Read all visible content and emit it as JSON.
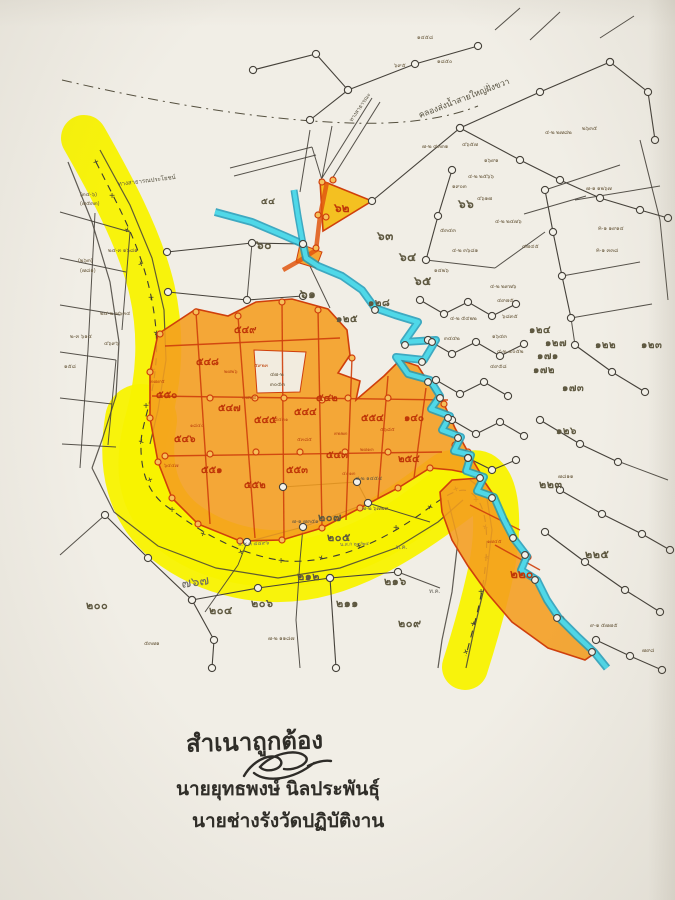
{
  "certification": {
    "line1": "สำเนาถูกต้อง",
    "line2": "นายยุทธพงษ์ นิลประพันธุ์",
    "line3": "นายช่างรังวัดปฏิบัติงาน"
  },
  "map": {
    "colors": {
      "road_highlight": "#f8f200",
      "parcel_highlight": "#f49d1f",
      "parcel_line": "#cf3f0c",
      "stream_fill": "#4fd8e8",
      "stream_edge": "#1f9cba",
      "ink": "#45413a",
      "paper": "#f1eee6"
    },
    "labels": [
      {
        "t": "๖๐",
        "x": 256,
        "y": 249,
        "c": "num",
        "s": 12
      },
      {
        "t": "๖๑",
        "x": 300,
        "y": 298,
        "c": "num",
        "s": 12
      },
      {
        "t": "๖๒",
        "x": 334,
        "y": 212,
        "c": "red",
        "s": 12
      },
      {
        "t": "๖๓",
        "x": 377,
        "y": 240,
        "c": "num",
        "s": 12
      },
      {
        "t": "๖๔",
        "x": 399,
        "y": 261,
        "c": "num",
        "s": 12
      },
      {
        "t": "๖๕",
        "x": 414,
        "y": 285,
        "c": "num",
        "s": 12
      },
      {
        "t": "๖๖",
        "x": 458,
        "y": 208,
        "c": "num",
        "s": 12
      },
      {
        "t": "๕๔",
        "x": 261,
        "y": 204,
        "c": "num",
        "s": 9
      },
      {
        "t": "๑๒๘",
        "x": 368,
        "y": 306,
        "c": "num",
        "s": 10
      },
      {
        "t": "๑๒๕",
        "x": 336,
        "y": 322,
        "c": "num",
        "s": 10
      },
      {
        "t": "๑๒๔",
        "x": 529,
        "y": 333,
        "c": "num",
        "s": 10
      },
      {
        "t": "๑๒๗",
        "x": 545,
        "y": 346,
        "c": "num",
        "s": 10
      },
      {
        "t": "๑๗๑",
        "x": 537,
        "y": 359,
        "c": "num",
        "s": 10
      },
      {
        "t": "๑๗๒",
        "x": 533,
        "y": 373,
        "c": "num",
        "s": 10
      },
      {
        "t": "๑๗๓",
        "x": 562,
        "y": 391,
        "c": "num",
        "s": 10
      },
      {
        "t": "๑๒๒",
        "x": 595,
        "y": 348,
        "c": "num",
        "s": 10
      },
      {
        "t": "๑๒๓",
        "x": 641,
        "y": 348,
        "c": "num",
        "s": 10
      },
      {
        "t": "๑๒๖",
        "x": 556,
        "y": 434,
        "c": "num",
        "s": 10
      },
      {
        "t": "๒๒๓",
        "x": 539,
        "y": 488,
        "c": "num",
        "s": 11
      },
      {
        "t": "๒๒๕",
        "x": 585,
        "y": 558,
        "c": "num",
        "s": 11
      },
      {
        "t": "๒๐๐",
        "x": 86,
        "y": 609,
        "c": "num",
        "s": 11
      },
      {
        "t": "๒๐๔",
        "x": 209,
        "y": 614,
        "c": "num",
        "s": 11
      },
      {
        "t": "๒๐๕",
        "x": 327,
        "y": 541,
        "c": "num",
        "s": 11
      },
      {
        "t": "๒๐๗",
        "x": 318,
        "y": 521,
        "c": "num",
        "s": 11
      },
      {
        "t": "๒๐๖",
        "x": 251,
        "y": 607,
        "c": "num",
        "s": 11
      },
      {
        "t": "๒๑๑",
        "x": 336,
        "y": 607,
        "c": "num",
        "s": 11
      },
      {
        "t": "๒๑๒",
        "x": 297,
        "y": 580,
        "c": "num",
        "s": 11
      },
      {
        "t": "๒๑๖",
        "x": 384,
        "y": 585,
        "c": "num",
        "s": 11
      },
      {
        "t": "๒๐๙",
        "x": 398,
        "y": 627,
        "c": "num",
        "s": 11
      },
      {
        "t": "๑๔๐",
        "x": 404,
        "y": 421,
        "c": "red",
        "s": 10
      },
      {
        "t": "๒๕๔",
        "x": 398,
        "y": 462,
        "c": "red",
        "s": 10
      },
      {
        "t": "๒๒๐",
        "x": 510,
        "y": 578,
        "c": "red",
        "s": 12
      },
      {
        "t": "๕๔๙",
        "x": 234,
        "y": 333,
        "c": "red",
        "s": 10
      },
      {
        "t": "๕๔๘",
        "x": 196,
        "y": 365,
        "c": "red",
        "s": 10
      },
      {
        "t": "๕๕๐",
        "x": 156,
        "y": 398,
        "c": "red",
        "s": 10
      },
      {
        "t": "๕๔๗",
        "x": 218,
        "y": 411,
        "c": "red",
        "s": 10
      },
      {
        "t": "๕๔๖",
        "x": 174,
        "y": 442,
        "c": "red",
        "s": 10
      },
      {
        "t": "๕๕๑",
        "x": 201,
        "y": 473,
        "c": "red",
        "s": 10
      },
      {
        "t": "๕๕๒",
        "x": 244,
        "y": 488,
        "c": "red",
        "s": 10
      },
      {
        "t": "๕๔๕",
        "x": 254,
        "y": 423,
        "c": "red",
        "s": 10
      },
      {
        "t": "๕๔๔",
        "x": 294,
        "y": 415,
        "c": "red",
        "s": 10
      },
      {
        "t": "๕๕๓",
        "x": 286,
        "y": 473,
        "c": "red",
        "s": 10
      },
      {
        "t": "๕๔๓",
        "x": 326,
        "y": 458,
        "c": "red",
        "s": 10
      },
      {
        "t": "๕๔๒",
        "x": 316,
        "y": 401,
        "c": "red",
        "s": 10
      },
      {
        "t": "๕๕๔",
        "x": 361,
        "y": 421,
        "c": "red",
        "s": 10
      },
      {
        "t": "๔-๒ ๒๗๘๒",
        "x": 545,
        "y": 134,
        "c": "tiny",
        "s": 5.5
      },
      {
        "t": "๒๖๓๕",
        "x": 582,
        "y": 130,
        "c": "tiny",
        "s": 5.5
      },
      {
        "t": "๗-๑ ๑๒๖๗",
        "x": 586,
        "y": 190,
        "c": "tiny",
        "s": 5.5
      },
      {
        "t": "ค-๑ ๑๙๑๔",
        "x": 598,
        "y": 230,
        "c": "tiny",
        "s": 5.5
      },
      {
        "t": "ค-๑ ๓๓๘",
        "x": 596,
        "y": 252,
        "c": "tiny",
        "s": 5.5
      },
      {
        "t": "๔-๒ ๒๔๗๖",
        "x": 495,
        "y": 223,
        "c": "tiny",
        "s": 5.5
      },
      {
        "t": "๔๗๔๕",
        "x": 522,
        "y": 248,
        "c": "tiny",
        "s": 5.5
      },
      {
        "t": "๔-๒ ๒๙๗๖",
        "x": 490,
        "y": 288,
        "c": "tiny",
        "s": 5.5
      },
      {
        "t": "๔๙๗๕",
        "x": 497,
        "y": 302,
        "c": "tiny",
        "s": 5.5
      },
      {
        "t": "๖๘๓๕",
        "x": 502,
        "y": 318,
        "c": "tiny",
        "s": 5.5
      },
      {
        "t": "๑๖๔๓",
        "x": 492,
        "y": 338,
        "c": "tiny",
        "s": 5.5
      },
      {
        "t": "๔-๒ ๔๐๕๒",
        "x": 497,
        "y": 353,
        "c": "tiny",
        "s": 5.5
      },
      {
        "t": "๔๙๕๘",
        "x": 490,
        "y": 368,
        "c": "tiny",
        "s": 5.5
      },
      {
        "t": "๔-๒ ๕๔๒๒",
        "x": 450,
        "y": 320,
        "c": "tiny",
        "s": 5.5
      },
      {
        "t": "๓๔๔๒",
        "x": 444,
        "y": 340,
        "c": "tiny",
        "s": 5.5
      },
      {
        "t": "๕๓๔๓",
        "x": 440,
        "y": 232,
        "c": "tiny",
        "s": 5.5
      },
      {
        "t": "๔-๒ ๓๖๘๑",
        "x": 452,
        "y": 252,
        "c": "tiny",
        "s": 5.5
      },
      {
        "t": "๑๔๒๖",
        "x": 434,
        "y": 272,
        "c": "tiny",
        "s": 5.5
      },
      {
        "t": "๔๖๕๗",
        "x": 462,
        "y": 146,
        "c": "tiny",
        "s": 5.5
      },
      {
        "t": "๑๖๙๑",
        "x": 484,
        "y": 162,
        "c": "tiny",
        "s": 5.5
      },
      {
        "t": "๔-๒ ๒๕๖๖",
        "x": 468,
        "y": 178,
        "c": "tiny",
        "s": 5.5
      },
      {
        "t": "๑๙๐๓",
        "x": 452,
        "y": 188,
        "c": "tiny",
        "s": 5.5
      },
      {
        "t": "๔๖๑๗",
        "x": 477,
        "y": 200,
        "c": "tiny",
        "s": 5.5
      },
      {
        "t": "๗-๒ ๔๓๓๑",
        "x": 422,
        "y": 148,
        "c": "tiny",
        "s": 5.5
      },
      {
        "t": "(๓๔-๖)",
        "x": 80,
        "y": 196,
        "c": "tiny",
        "s": 5.5
      },
      {
        "t": "(๗๕๓๓)",
        "x": 80,
        "y": 205,
        "c": "tiny",
        "s": 5.5
      },
      {
        "t": "๒๔-๓ ๑๖๘๑",
        "x": 108,
        "y": 252,
        "c": "tiny",
        "s": 5.5
      },
      {
        "t": "(๒๖๓)",
        "x": 78,
        "y": 262,
        "c": "tiny",
        "s": 5.5
      },
      {
        "t": "(๗๘๑)",
        "x": 80,
        "y": 272,
        "c": "tiny",
        "s": 5.5
      },
      {
        "t": "๒๔-๒ ๗๖๓๔",
        "x": 100,
        "y": 315,
        "c": "tiny",
        "s": 5.5
      },
      {
        "t": "๒-๓ ๖๑๔",
        "x": 70,
        "y": 338,
        "c": "tiny",
        "s": 5.5
      },
      {
        "t": "๔๖๙๖",
        "x": 104,
        "y": 345,
        "c": "tiny",
        "s": 5.5
      },
      {
        "t": "๑๕๘",
        "x": 64,
        "y": 368,
        "c": "tiny",
        "s": 5.5
      },
      {
        "t": "๑๔๕๘",
        "x": 417,
        "y": 39,
        "c": "tiny",
        "s": 5.5
      },
      {
        "t": "๖๙๕",
        "x": 394,
        "y": 67,
        "c": "tiny",
        "s": 5.5
      },
      {
        "t": "๑๘๕๐",
        "x": 437,
        "y": 63,
        "c": "tiny",
        "s": 5.5
      },
      {
        "t": "๔-๒ ๑๔๕๔",
        "x": 355,
        "y": 480,
        "c": "tiny",
        "s": 5.5
      },
      {
        "t": "๗-๒ ๖๗๒๙",
        "x": 362,
        "y": 510,
        "c": "tiny",
        "s": 5.5
      },
      {
        "t": "๗-๑ ๗๓๕๑",
        "x": 292,
        "y": 523,
        "c": "tiny",
        "s": 5.5
      },
      {
        "t": "๗-๒ ๑๑๘๗",
        "x": 268,
        "y": 640,
        "c": "tiny",
        "s": 5.5
      },
      {
        "t": "๕๓๗๑",
        "x": 144,
        "y": 645,
        "c": "tiny",
        "s": 5.5
      },
      {
        "t": "๙-๑ ๕๗๗๕",
        "x": 590,
        "y": 627,
        "c": "tiny",
        "s": 5.5
      },
      {
        "t": "๗๙๘",
        "x": 642,
        "y": 652,
        "c": "tiny",
        "s": 5.5
      },
      {
        "t": "๗๘๑๑",
        "x": 558,
        "y": 478,
        "c": "tiny",
        "s": 5.5
      },
      {
        "t": "๔๗-๒",
        "x": 270,
        "y": 376,
        "c": "tiny",
        "s": 5.5
      },
      {
        "t": "๓๐๕๓",
        "x": 270,
        "y": 386,
        "c": "tiny",
        "s": 5.5
      },
      {
        "t": "๓๗๙๕",
        "x": 150,
        "y": 383,
        "c": "tinyred",
        "s": 5
      },
      {
        "t": "๒๗๒๖",
        "x": 224,
        "y": 373,
        "c": "tinyred",
        "s": 5
      },
      {
        "t": "๕๙๒๓",
        "x": 254,
        "y": 367,
        "c": "tinyred",
        "s": 5
      },
      {
        "t": "๘๔๓๑",
        "x": 274,
        "y": 421,
        "c": "tinyred",
        "s": 5
      },
      {
        "t": "๕๓๘๕",
        "x": 297,
        "y": 441,
        "c": "tinyred",
        "s": 5
      },
      {
        "t": "๑๘๔๐",
        "x": 190,
        "y": 427,
        "c": "tinyred",
        "s": 5
      },
      {
        "t": "๖๔๔๗",
        "x": 164,
        "y": 467,
        "c": "tinyred",
        "s": 5
      },
      {
        "t": "๓๗๒๔",
        "x": 242,
        "y": 399,
        "c": "tinyred",
        "s": 5
      },
      {
        "t": "๓๒๒๓",
        "x": 334,
        "y": 435,
        "c": "tinyred",
        "s": 5
      },
      {
        "t": "๔๐๑๓",
        "x": 342,
        "y": 475,
        "c": "tinyred",
        "s": 5
      },
      {
        "t": "๒๗๑๓",
        "x": 360,
        "y": 451,
        "c": "tinyred",
        "s": 5
      },
      {
        "t": "๕๖๘๕",
        "x": 380,
        "y": 431,
        "c": "tinyred",
        "s": 5
      },
      {
        "t": "๑๗๔๕",
        "x": 487,
        "y": 543,
        "c": "tinyred",
        "s": 5
      },
      {
        "t": "๗๖๗",
        "x": 182,
        "y": 588,
        "c": "pencil",
        "s": 13,
        "r": -8
      },
      {
        "t": "ท.ค.",
        "x": 396,
        "y": 549,
        "c": "pencil",
        "s": 6
      },
      {
        "t": "ท.ค.",
        "x": 429,
        "y": 593,
        "c": "pencil",
        "s": 6
      },
      {
        "t": "พ.ช.ด ๔๔๙๖",
        "x": 238,
        "y": 546,
        "c": "pencil",
        "s": 5.5,
        "r": -3
      },
      {
        "t": "น.ส.ก ๒๙/๒๔",
        "x": 340,
        "y": 546,
        "c": "pencil",
        "s": 5,
        "r": -2
      },
      {
        "t": "คลองส่งน้ำสายใหญ่ฝั่งขวา",
        "x": 420,
        "y": 118,
        "c": "road",
        "s": 8.5,
        "r": -21
      },
      {
        "t": "ทางสาธารณประโยชน์",
        "x": 118,
        "y": 186,
        "c": "road",
        "s": 6,
        "r": -7
      },
      {
        "t": "ทางสาธารณะ",
        "x": 352,
        "y": 122,
        "c": "road",
        "s": 5.5,
        "r": -56
      }
    ]
  }
}
